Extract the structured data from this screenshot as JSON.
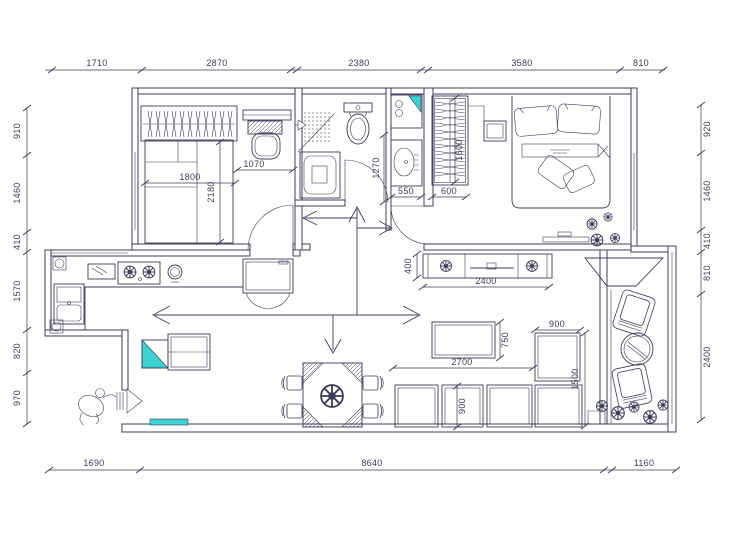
{
  "colors": {
    "line": "#3c3c5a",
    "accent": "#3bd2d2",
    "background": "#ffffff"
  },
  "dimensions": {
    "top": [
      "1710",
      "2870",
      "2380",
      "3580",
      "810"
    ],
    "left": [
      "910",
      "1460",
      "410",
      "1570",
      "820",
      "970"
    ],
    "right": [
      "920",
      "1460",
      "410",
      "810",
      "2400"
    ],
    "bottom": [
      "1690",
      "8640",
      "1160"
    ],
    "interior": {
      "bedroom1_bed_width": "1800",
      "bedroom1_bed_length": "2180",
      "bedroom1_desk_width": "1070",
      "wash_alcove_depth": "1270",
      "wash_basin_width": "550",
      "bedroom2_wardrobe_width": "600",
      "bedroom2_wardrobe_length": "1600",
      "tv_unit_depth": "400",
      "tv_unit_length": "2400",
      "coffee_table_depth": "750",
      "sofa_length": "2700",
      "sofa_corner_width": "900",
      "sofa_module_depth": "900",
      "sofa_side_length": "1500"
    }
  }
}
